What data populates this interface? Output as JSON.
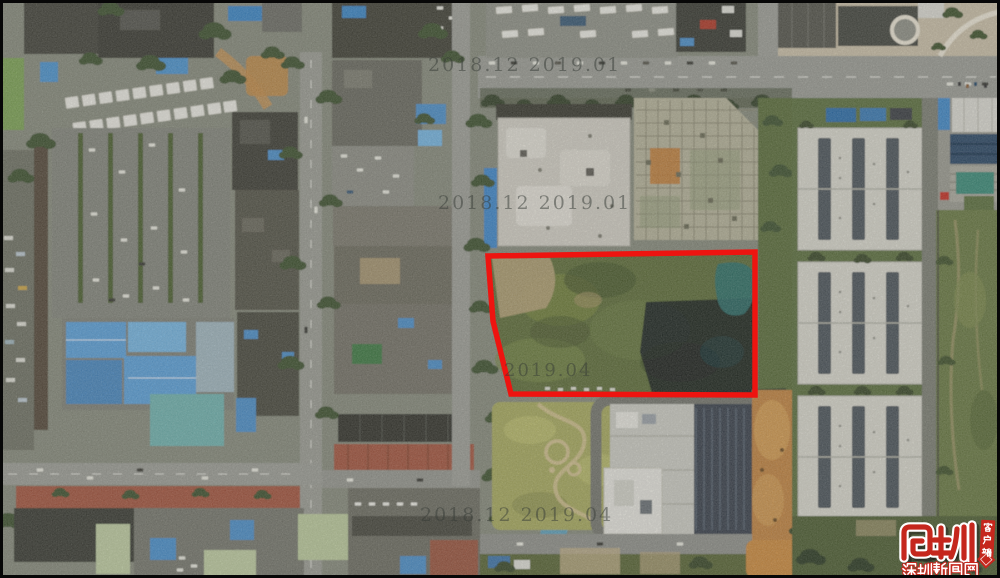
{
  "image": {
    "type": "aerial-satellite-photo",
    "description": "Aerial satellite photo of an urban district; a vacant green parcel is outlined in red between an urban village, warehouses and an office building",
    "parcel_outline_color": "#ee1410"
  },
  "watermarks": {
    "top": "2018.12 2019.01",
    "middle": "2018.12 2019.01",
    "parcel": "2019.04",
    "bottom": "2018.12 2019.04"
  },
  "logo": {
    "mark_character": "圳",
    "site_name": "深圳新闻网",
    "ribbon_label": "客户端",
    "brand_color": "#c5271d"
  }
}
